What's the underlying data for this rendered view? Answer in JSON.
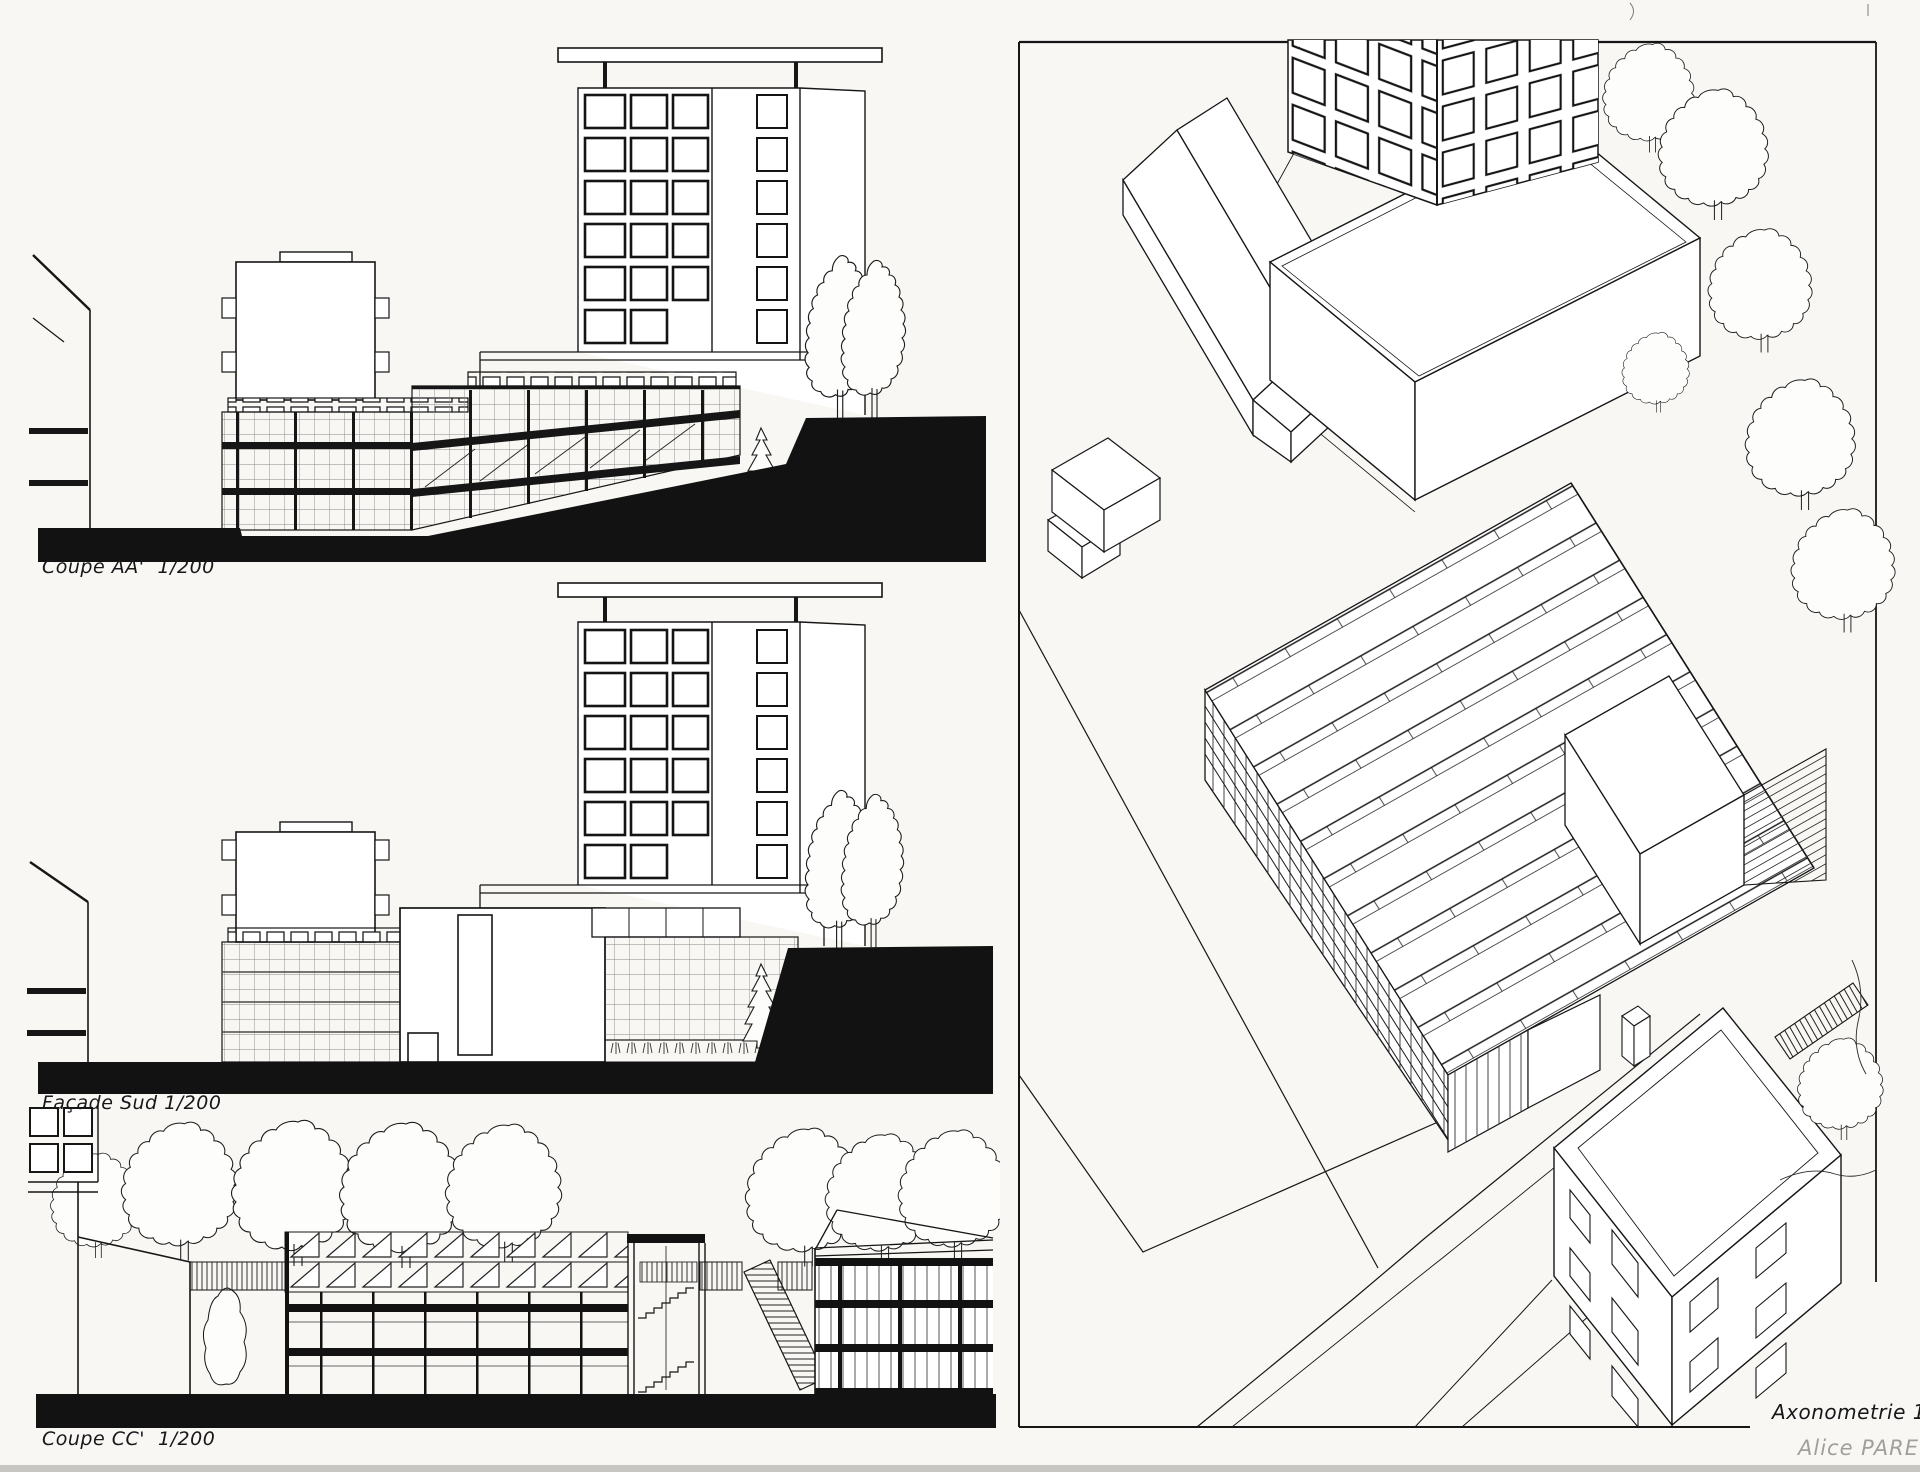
{
  "document": {
    "kind": "architecture presentation board (hand drawn)",
    "paper_color": "#f8f7f4",
    "ink_color": "#161616",
    "pencil_color": "#a19f9a",
    "glazing_grid_color": "#8a8a8a"
  },
  "panels": {
    "coupe_aa": {
      "label": "Coupe AA'  1/200"
    },
    "facade_sud": {
      "label": "Façade Sud 1/200"
    },
    "coupe_cc": {
      "label": "Coupe CC'  1/200"
    },
    "axonometrie": {
      "label": "Axonometrie 1/200"
    }
  },
  "signature": {
    "name": "Alice PARET"
  },
  "scale_note": "1/200"
}
